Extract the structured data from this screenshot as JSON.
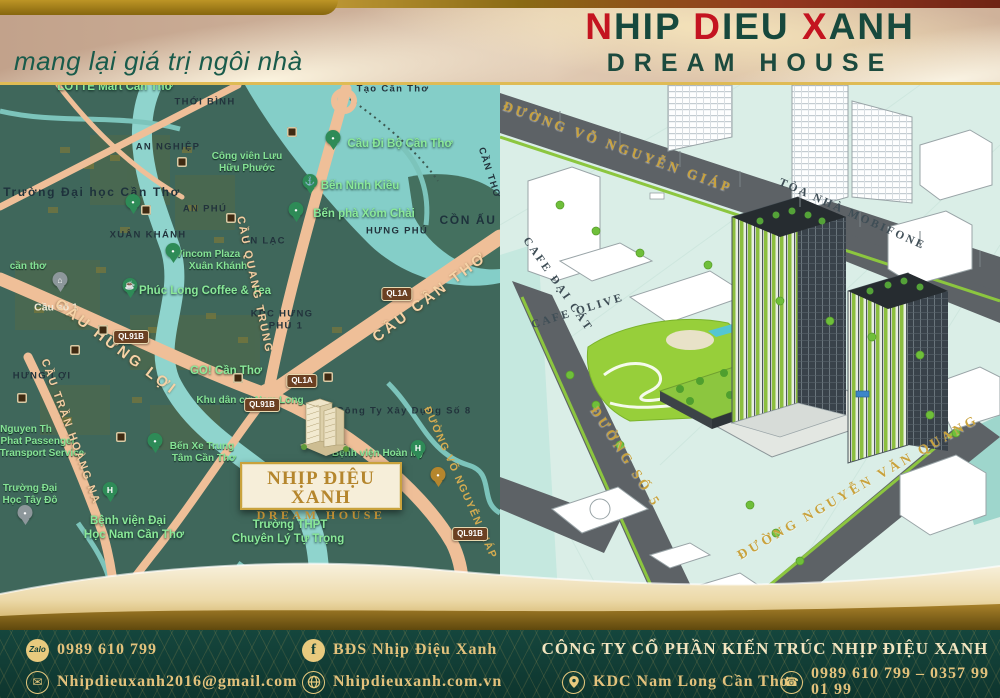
{
  "header": {
    "tagline": "mang lại giá trị ngôi nhà",
    "title_segments": [
      {
        "text": "N",
        "color": "#c41420"
      },
      {
        "text": "HIP ",
        "color": "#17493d"
      },
      {
        "text": "D",
        "color": "#c41420"
      },
      {
        "text": "IEU ",
        "color": "#17493d"
      },
      {
        "text": "X",
        "color": "#c41420"
      },
      {
        "text": "ANH",
        "color": "#17493d"
      }
    ],
    "subtitle": "DREAM HOUSE"
  },
  "map": {
    "project": {
      "title": "NHỊP ĐIỆU XANH",
      "subtitle": "DREAM HOUSE"
    },
    "pin_colors": {
      "green": "#2e8b57",
      "gray": "#8d979b",
      "gold": "#b5862d"
    },
    "labels": [
      {
        "t": "LOTTE Mart Cần Thơ",
        "x": 115,
        "y": 3,
        "cls": "green-lg"
      },
      {
        "t": "THỚI BÌNH",
        "x": 205,
        "y": 17,
        "cls": "dark"
      },
      {
        "t": "Tạo Cần Thơ",
        "x": 393,
        "y": 4,
        "cls": "dark"
      },
      {
        "t": "AN NGHIỆP",
        "x": 168,
        "y": 62,
        "cls": "dark"
      },
      {
        "t": "Công viên Lưu",
        "x": 247,
        "y": 72,
        "cls": "green"
      },
      {
        "t": "Hữu Phước",
        "x": 247,
        "y": 84,
        "cls": "green"
      },
      {
        "t": "Cầu Đi Bộ Cần Thơ",
        "x": 400,
        "y": 60,
        "cls": "green-lg"
      },
      {
        "t": "Trường Đại học Cần Thơ",
        "x": 92,
        "y": 107,
        "cls": "dark-lg"
      },
      {
        "t": "AN PHÚ",
        "x": 205,
        "y": 124,
        "cls": "dark"
      },
      {
        "t": "Bến Ninh Kiều",
        "x": 360,
        "y": 102,
        "cls": "green-lg"
      },
      {
        "t": "XUÂN KHÁNH",
        "x": 148,
        "y": 150,
        "cls": "dark"
      },
      {
        "t": "AN LẠC",
        "x": 264,
        "y": 156,
        "cls": "dark"
      },
      {
        "t": "Bến phà Xóm Chài",
        "x": 364,
        "y": 130,
        "cls": "green-lg"
      },
      {
        "t": "HƯNG PHÚ",
        "x": 397,
        "y": 146,
        "cls": "dark"
      },
      {
        "t": "CỒN ẤU",
        "x": 468,
        "y": 135,
        "cls": "dark-lg"
      },
      {
        "t": "Vincom Plaza",
        "x": 208,
        "y": 170,
        "cls": "green"
      },
      {
        "t": "Xuân Khánh",
        "x": 218,
        "y": 182,
        "cls": "green"
      },
      {
        "t": "cần thơ",
        "x": 28,
        "y": 182,
        "cls": "green"
      },
      {
        "t": "Phúc Long Coffee & Tea",
        "x": 205,
        "y": 207,
        "cls": "green-lg"
      },
      {
        "t": "Cầu số 1",
        "x": 56,
        "y": 223,
        "cls": "white"
      },
      {
        "t": "KDC HƯNG",
        "x": 282,
        "y": 229,
        "cls": "dark"
      },
      {
        "t": "PHÚ 1",
        "x": 286,
        "y": 241,
        "cls": "dark"
      },
      {
        "t": "HƯNG LỢI",
        "x": 42,
        "y": 291,
        "cls": "dark"
      },
      {
        "t": "GO! Cần Thơ",
        "x": 226,
        "y": 287,
        "cls": "green-lg"
      },
      {
        "t": "Công Ty Xây Dựng Số 8",
        "x": 404,
        "y": 326,
        "cls": "dark"
      },
      {
        "t": "Khu dân cư Nam Long",
        "x": 250,
        "y": 316,
        "cls": "green"
      },
      {
        "t": "Bệnh viện Hoàn Mỹ",
        "x": 378,
        "y": 369,
        "cls": "green"
      },
      {
        "t": "Nguyen Th",
        "x": 26,
        "y": 345,
        "cls": "green"
      },
      {
        "t": "Phat Passenger",
        "x": 38,
        "y": 357,
        "cls": "green"
      },
      {
        "t": "Transport Service",
        "x": 42,
        "y": 369,
        "cls": "green"
      },
      {
        "t": "Bến Xe Trung",
        "x": 202,
        "y": 362,
        "cls": "green"
      },
      {
        "t": "Tâm Cần Thơ",
        "x": 204,
        "y": 374,
        "cls": "green"
      },
      {
        "t": "Trường Đại",
        "x": 30,
        "y": 404,
        "cls": "green"
      },
      {
        "t": "Học Tây Đô",
        "x": 30,
        "y": 416,
        "cls": "green"
      },
      {
        "t": "Bệnh viện Đại",
        "x": 128,
        "y": 437,
        "cls": "green-lg"
      },
      {
        "t": "Học Nam Cần Thơ",
        "x": 134,
        "y": 451,
        "cls": "green-lg"
      },
      {
        "t": "Trường THPT",
        "x": 290,
        "y": 441,
        "cls": "green-lg"
      },
      {
        "t": "Chuyên Lý Tự Trọng",
        "x": 288,
        "y": 455,
        "cls": "green-lg"
      },
      {
        "t": "PHÚ THỨ",
        "x": 426,
        "y": 500,
        "cls": "dark"
      },
      {
        "t": "CẦU QUANG TRUNG",
        "x": 254,
        "y": 200,
        "rot": 78,
        "cls": "peach"
      },
      {
        "t": "CẦU HƯNG LỢI",
        "x": 116,
        "y": 262,
        "rot": 37,
        "cls": "peach-lg"
      },
      {
        "t": "CẦU CẦN THƠ",
        "x": 430,
        "y": 212,
        "rot": -37,
        "cls": "peach-lg"
      },
      {
        "t": "CẦU TRẦN HOÀNG NA",
        "x": 70,
        "y": 347,
        "rot": 70,
        "cls": "peach"
      },
      {
        "t": "ĐƯỜNG VÕ NGUYỄN GIÁP",
        "x": 460,
        "y": 398,
        "rot": 66,
        "cls": "goldrot"
      },
      {
        "t": "CẦN THƠ",
        "x": 489,
        "y": 88,
        "rot": 72,
        "cls": "dark"
      }
    ],
    "badges": [
      {
        "t": "QL1A",
        "x": 302,
        "y": 296
      },
      {
        "t": "QL1A",
        "x": 397,
        "y": 209
      },
      {
        "t": "QL91B",
        "x": 131,
        "y": 252
      },
      {
        "t": "QL91B",
        "x": 262,
        "y": 320
      },
      {
        "t": "QL91B",
        "x": 470,
        "y": 449
      }
    ],
    "pins": [
      {
        "x": 333,
        "y": 60,
        "v": "green",
        "g": "•"
      },
      {
        "x": 310,
        "y": 104,
        "v": "green",
        "g": "⚓"
      },
      {
        "x": 296,
        "y": 132,
        "v": "green",
        "g": "•"
      },
      {
        "x": 133,
        "y": 124,
        "v": "green",
        "g": "•"
      },
      {
        "x": 130,
        "y": 208,
        "v": "green",
        "g": "☕"
      },
      {
        "x": 173,
        "y": 173,
        "v": "green",
        "g": "•"
      },
      {
        "x": 110,
        "y": 412,
        "v": "green",
        "g": "H"
      },
      {
        "x": 418,
        "y": 370,
        "v": "green",
        "g": "H"
      },
      {
        "x": 60,
        "y": 202,
        "v": "gray",
        "g": "⌂"
      },
      {
        "x": 25,
        "y": 435,
        "v": "gray",
        "g": "•"
      },
      {
        "x": 155,
        "y": 363,
        "v": "green",
        "g": "•"
      },
      {
        "x": 438,
        "y": 397,
        "v": "gold",
        "g": "•"
      }
    ],
    "transit": [
      {
        "x": 182,
        "y": 77
      },
      {
        "x": 292,
        "y": 47
      },
      {
        "x": 231,
        "y": 133
      },
      {
        "x": 146,
        "y": 125
      },
      {
        "x": 103,
        "y": 245
      },
      {
        "x": 75,
        "y": 265
      },
      {
        "x": 22,
        "y": 313
      },
      {
        "x": 328,
        "y": 292
      },
      {
        "x": 238,
        "y": 293
      },
      {
        "x": 121,
        "y": 352
      }
    ]
  },
  "render": {
    "labels": [
      {
        "t": "ĐƯỜNG VÕ NGUYỄN GIÁP",
        "x": 118,
        "y": 62,
        "rot": 20,
        "cls": "gold-lg"
      },
      {
        "t": "TÒA NHÀ MOBIFONE",
        "x": 352,
        "y": 130,
        "rot": 24,
        "cls": "darkname"
      },
      {
        "t": "CAFE ĐẠI CÁT",
        "x": 57,
        "y": 200,
        "rot": 55,
        "cls": "darkname"
      },
      {
        "t": "CAFE OLIVE",
        "x": 78,
        "y": 227,
        "rot": -17,
        "cls": "darkname"
      },
      {
        "t": "ĐƯỜNG SỐ 5",
        "x": 126,
        "y": 372,
        "rot": 57,
        "cls": "gold-lg"
      },
      {
        "t": "ĐƯỜNG NGUYỄN VĂN QUANG",
        "x": 358,
        "y": 402,
        "rot": -30,
        "cls": "gold-lg"
      }
    ]
  },
  "footer": {
    "company": "CÔNG TY CỔ PHẦN KIẾN TRÚC NHỊP ĐIỆU XANH",
    "zalo_label": "Zalo",
    "glyphs": {
      "email": "✉",
      "facebook": "f",
      "phone": "☎"
    },
    "items": [
      {
        "name": "zalo-phone",
        "text": "0989 610 799"
      },
      {
        "name": "email",
        "text": "Nhipdieuxanh2016@gmail.com"
      },
      {
        "name": "facebook",
        "text": "BĐS Nhịp Điệu Xanh"
      },
      {
        "name": "website",
        "text": "Nhipdieuxanh.com.vn"
      },
      {
        "name": "address",
        "text": "KDC Nam Long Cần Thơ"
      },
      {
        "name": "hotline",
        "text": "0989 610 799 – 0357 99 01 99"
      }
    ]
  },
  "colors": {
    "brand_red": "#c41420",
    "brand_green": "#17493d",
    "gold": "#c9a23c",
    "footer_bg": "#123f37",
    "map_bg": "#3f675b",
    "render_bg": "#daeee7"
  }
}
